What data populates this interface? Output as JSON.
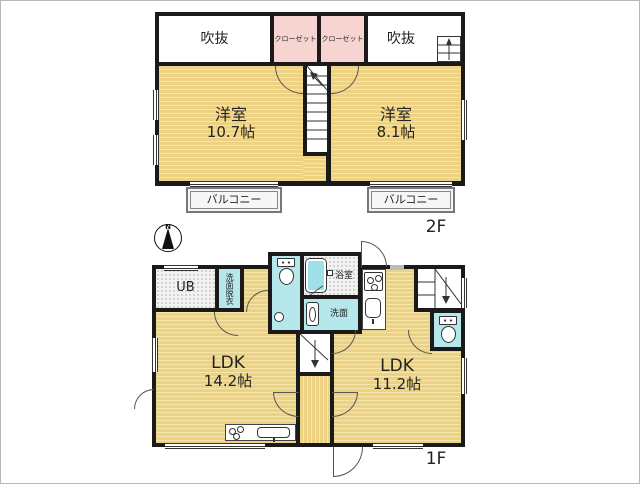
{
  "plan_type": "floor-plan",
  "compass": {
    "north_label": "N"
  },
  "colors": {
    "floor": "#eed283",
    "floor_stripe": "#f6e5a8",
    "closet_pink": "#f7d4d2",
    "water_cyan": "#b5e7eb",
    "bathtub_cyan": "#9fdfe8",
    "wall": "#1a1a1a"
  },
  "floor2": {
    "floor_label": "2F",
    "void_left_label": "吹抜",
    "closet_left_label": "クローゼット",
    "closet_right_label": "クローゼット",
    "void_right_label": "吹抜",
    "bedroom_left": {
      "name": "洋室",
      "area": "10.7帖"
    },
    "bedroom_right": {
      "name": "洋室",
      "area": "8.1帖"
    },
    "balcony_left_label": "バルコニー",
    "balcony_right_label": "バルコニー"
  },
  "floor1": {
    "floor_label": "1F",
    "unit_bath_label": "UB",
    "dressing_label": "洗面脱衣",
    "bath_label": "浴室",
    "washstand_label": "洗面",
    "ldk_left": {
      "name": "LDK",
      "area": "14.2帖"
    },
    "ldk_right": {
      "name": "LDK",
      "area": "11.2帖"
    }
  }
}
